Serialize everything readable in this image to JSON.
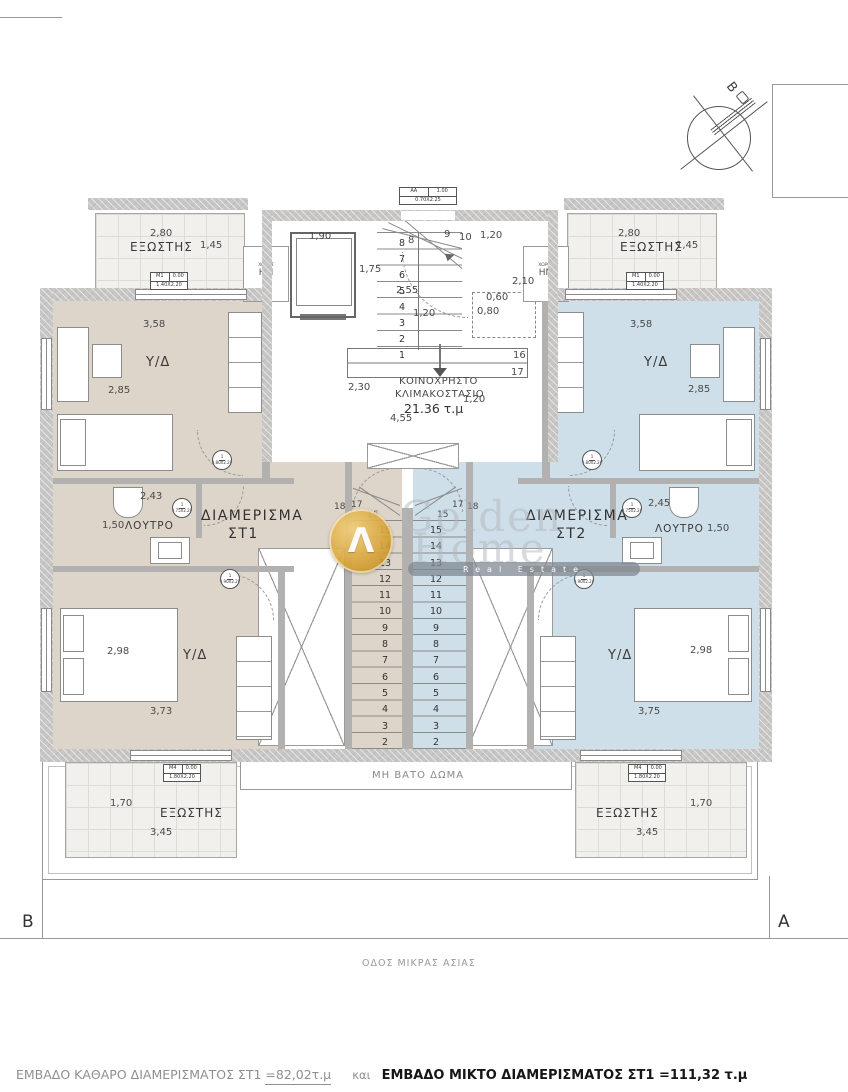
{
  "colors": {
    "apartment_st1_fill": "#ddd5c9",
    "apartment_st2_fill": "#cfdfe9",
    "wall_gray": "#c7c6c4",
    "logo_gold": "#d9a63c"
  },
  "compass": {
    "north": "Β"
  },
  "markers": {
    "left": "B",
    "right": "A"
  },
  "street": "ΟΔΟΣ ΜΙΚΡΑΣ ΑΣΙΑΣ",
  "roof": {
    "label": "ΜΗ ΒΑΤΟ ΔΩΜΑ"
  },
  "watermark": {
    "word1": "Golden",
    "word2": "Home",
    "tagline": "Real Estate",
    "glyph": "Λ"
  },
  "footer": {
    "net_label": "ΕΜΒΑΔΟ ΚΑΘΑΡΟ ΔΙΑΜΕΡΙΣΜΑΤΟΣ ΣΤ1 ",
    "net_value": "=82,02τ.μ",
    "conj": "και",
    "gross_label": "ΕΜΒΑΔΟ  ΜΙΚΤΟ ΔΙΑΜΕΡΙΣΜΑΤΟΣ ΣΤ1 ",
    "gross_value": "=111,32 τ.μ"
  },
  "core": {
    "label1": "ΚΟΙΝΟΧΡΗΣΤΟ",
    "label2": "ΚΛΙΜΑΚΟΣΤΑΣΙΟ",
    "area": "21.36 τ.μ",
    "elevator_w": "1,90",
    "elevator_d": "1,75",
    "stair_run": "2,55",
    "tread_w": "1,20",
    "top_width": "1,20",
    "landing_d": "2,10",
    "closet_w": "0,60",
    "closet_d": "0,80",
    "left_d": "2,30",
    "total_w": "4,55",
    "right_d": "1,20",
    "steps_up": "8\n7\n6\n5\n4\n3\n2\n1",
    "fan_steps": [
      "8",
      "9",
      "10"
    ],
    "down_steps": [
      "16",
      "17"
    ],
    "entry_tag": {
      "c1": "ΑΑ",
      "c2": "1.00",
      "c3": "0.70Χ2.25"
    }
  },
  "st1": {
    "name1": "ΔΙΑΜΕΡΙΣΜΑ",
    "name2": "ΣΤ1",
    "bedroom_top": {
      "label": "Υ/Δ",
      "w": "3,58",
      "d": "2,85"
    },
    "bath": {
      "label": "ΛΟΥΤΡΟ",
      "w": "2,43",
      "d": "1,50"
    },
    "bedroom_bottom": {
      "label": "Υ/Δ",
      "d": "2,98",
      "w": "3,73"
    },
    "balcony_top": {
      "label": "ΕΞΩΣΤΗΣ",
      "w": "2,80",
      "d": "1,45",
      "tag": {
        "c1": "Μ1",
        "c2": "0.00",
        "c3": "1.40Χ2.20"
      }
    },
    "balcony_bottom": {
      "label": "ΕΞΩΣΤΗΣ",
      "w": "3,45",
      "d": "1,70",
      "tag": {
        "c1": "Μ4",
        "c2": "0.00",
        "c3": "1.80Χ2.20"
      }
    },
    "hm": {
      "line1": "ΧΩΡΟΣ",
      "line2": "ΗΜ"
    },
    "stair": {
      "fan": [
        "18",
        "17",
        "16"
      ],
      "steps": "15\n14\n13\n12\n11\n10\n9\n8\n7\n6\n5\n4\n3\n2"
    },
    "doors": [
      {
        "num": "1",
        "size": "0.80Χ2.20"
      },
      {
        "num": "1",
        "size": "0.75Χ2.20"
      },
      {
        "num": "1",
        "size": "0.90Χ2.20"
      }
    ]
  },
  "st2": {
    "name1": "ΔΙΑΜΕΡΙΣΜΑ",
    "name2": "ΣΤ2",
    "bedroom_top": {
      "label": "Υ/Δ",
      "w": "3,58",
      "d": "2,85"
    },
    "bath": {
      "label": "ΛΟΥΤΡΟ",
      "w": "2,45",
      "d": "1,50"
    },
    "bedroom_bottom": {
      "label": "Υ/Δ",
      "d": "2,98",
      "w": "3,75"
    },
    "balcony_top": {
      "label": "ΕΞΩΣΤΗΣ",
      "w": "2,80",
      "d": "1,45",
      "tag": {
        "c1": "Μ1",
        "c2": "0.00",
        "c3": "1.40Χ2.20"
      }
    },
    "balcony_bottom": {
      "label": "ΕΞΩΣΤΗΣ",
      "w": "3,45",
      "d": "1,70",
      "tag": {
        "c1": "Μ4",
        "c2": "0.00",
        "c3": "1.80Χ2.20"
      }
    },
    "hm": {
      "line1": "ΧΩΡΟΣ",
      "line2": "ΗΜ"
    },
    "stair": {
      "fan": [
        "15",
        "17",
        "18"
      ],
      "steps": "15\n14\n13\n12\n11\n10\n9\n8\n7\n6\n5\n4\n3\n2"
    },
    "doors": [
      {
        "num": "1",
        "size": "0.80Χ2.20"
      },
      {
        "num": "1",
        "size": "0.75Χ2.20"
      },
      {
        "num": "1",
        "size": "0.90Χ2.20"
      }
    ]
  }
}
